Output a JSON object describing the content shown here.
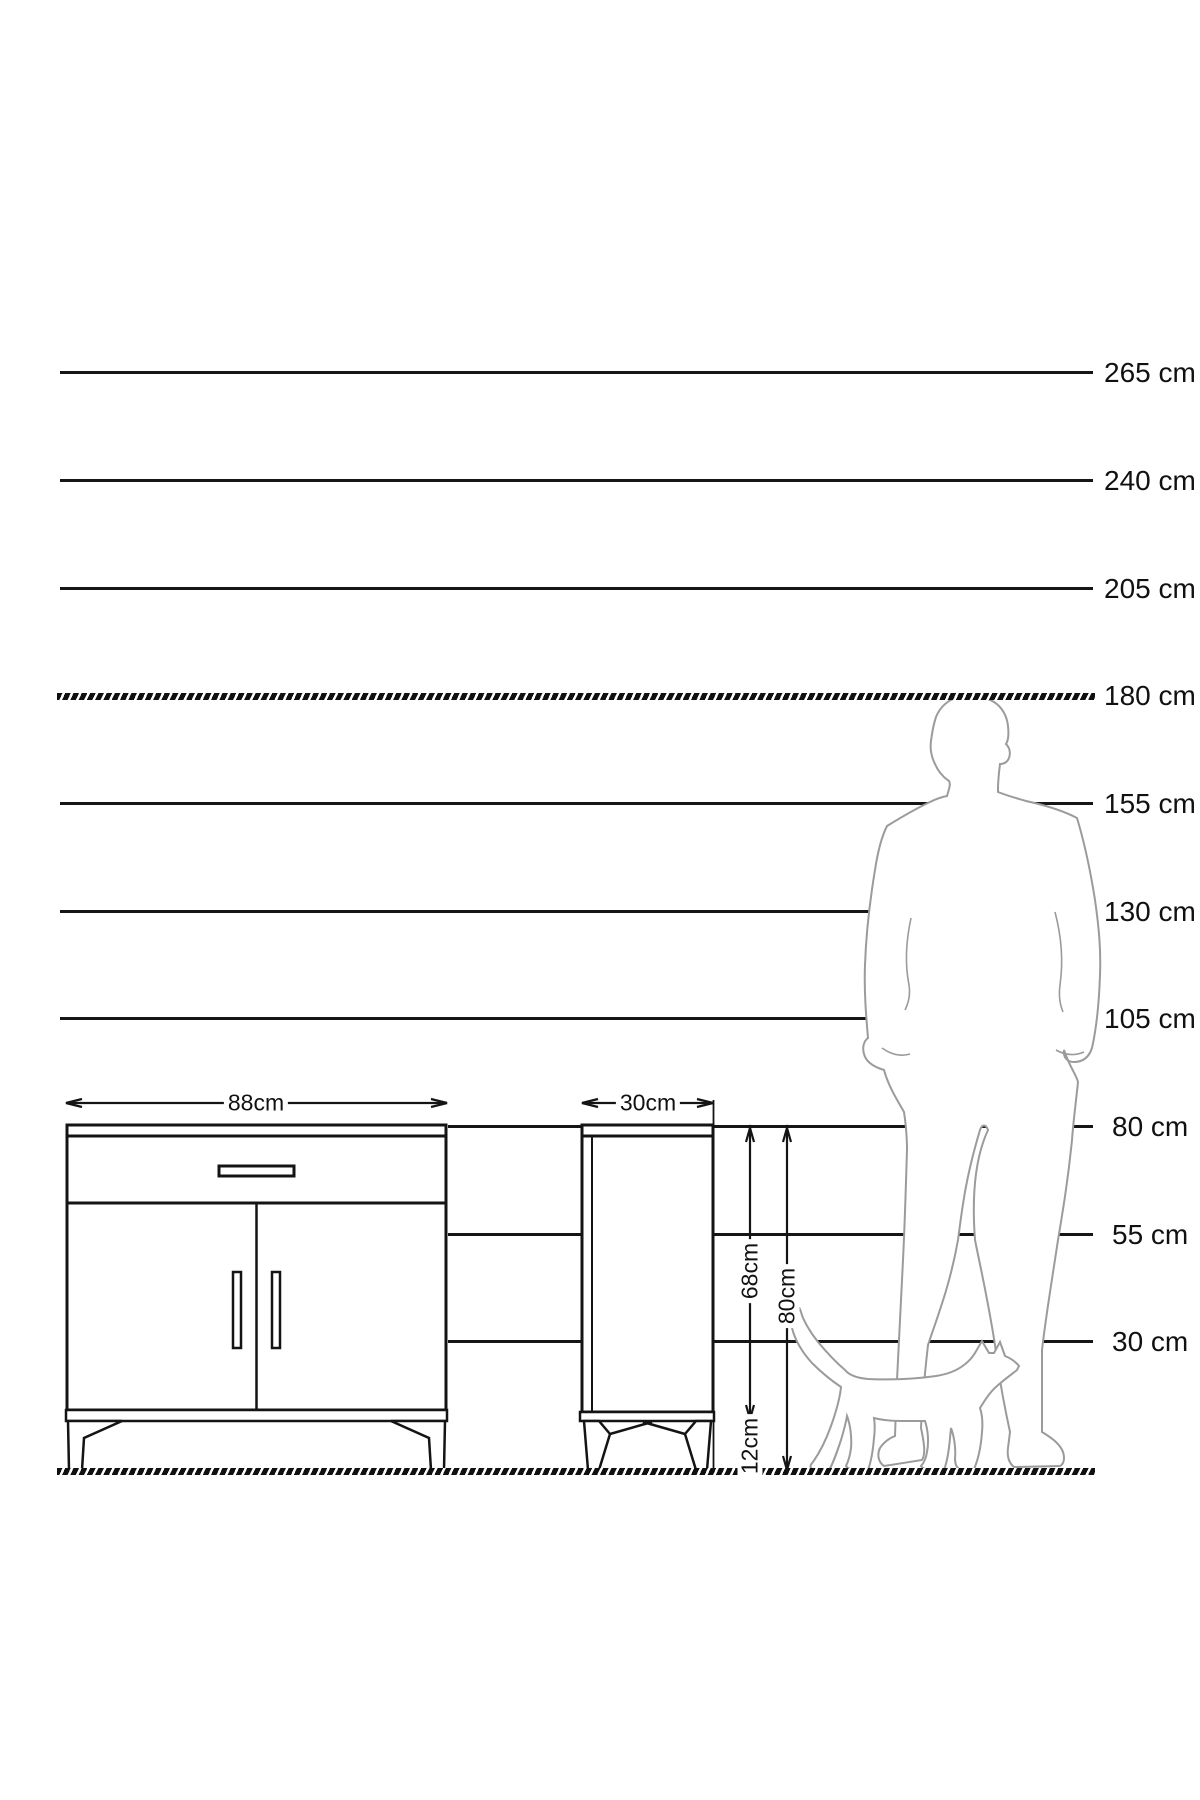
{
  "diagram": {
    "kind": "furniture-height-scale-diagram",
    "unit": "cm",
    "scale_lines": [
      {
        "label": "265 cm",
        "value": 265,
        "style": "solid"
      },
      {
        "label": "240 cm",
        "value": 240,
        "style": "solid"
      },
      {
        "label": "205 cm",
        "value": 205,
        "style": "solid"
      },
      {
        "label": "180 cm",
        "value": 180,
        "style": "hatched"
      },
      {
        "label": "155 cm",
        "value": 155,
        "style": "solid"
      },
      {
        "label": "130 cm",
        "value": 130,
        "style": "solid"
      },
      {
        "label": "105 cm",
        "value": 105,
        "style": "solid"
      },
      {
        "label": "80 cm",
        "value": 80,
        "style": "solid"
      },
      {
        "label": "55 cm",
        "value": 55,
        "style": "solid"
      },
      {
        "label": "30 cm",
        "value": 30,
        "style": "solid"
      }
    ],
    "dimensions": {
      "front_width": "88cm",
      "side_depth": "30cm",
      "body_height": "68cm",
      "total_height": "80cm",
      "leg_height": "12cm"
    },
    "figures": {
      "man": "man-silhouette-for-scale",
      "cat": "cat-silhouette-for-scale"
    },
    "colors": {
      "line": "#161616",
      "figure_outline": "#9b9b9b",
      "background": "#ffffff"
    }
  }
}
